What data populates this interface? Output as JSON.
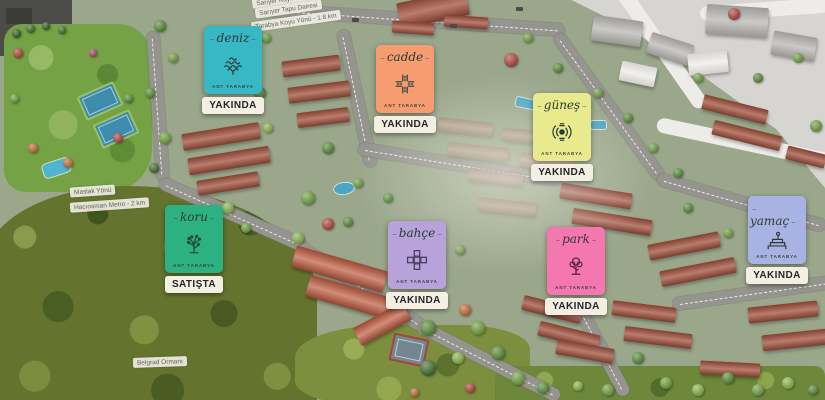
{
  "project": {
    "brand_label": "ANT TARABYA"
  },
  "cards": [
    {
      "name": "deniz",
      "brand": "ANT TARABYA",
      "status": "YAKINDA",
      "color": "#38b7c4",
      "icon": "sea-waves-icon"
    },
    {
      "name": "cadde",
      "brand": "ANT TARABYA",
      "status": "YAKINDA",
      "color": "#f59d70",
      "icon": "street-crossing-icon"
    },
    {
      "name": "güneş",
      "brand": "ANT TARABYA",
      "status": "YAKINDA",
      "color": "#e9e98d",
      "icon": "sun-icon"
    },
    {
      "name": "yamaç",
      "brand": "ANT TARABYA",
      "status": "YAKINDA",
      "color": "#a9b3e3",
      "icon": "hillside-icon"
    },
    {
      "name": "koru",
      "brand": "ANT TARABYA",
      "status": "SATIŞTA",
      "color": "#2db183",
      "icon": "grove-tree-icon"
    },
    {
      "name": "bahçe",
      "brand": "ANT TARABYA",
      "status": "YAKINDA",
      "color": "#b7a3da",
      "icon": "garden-plots-icon"
    },
    {
      "name": "park",
      "brand": "ANT TARABYA",
      "status": "YAKINDA",
      "color": "#f477b0",
      "icon": "park-tree-icon"
    }
  ],
  "map_labels": {
    "kaymakamlik": "Sarıyer Kaymakamlığı",
    "tapu": "Sarıyer Tapu Dairesi",
    "koy": "Tarabya Koyu Yönü - 1.8 km",
    "maslak": "Maslak Yönü",
    "metro": "Hacıosman Metro - 2 km",
    "orman": "Belgrad Ormanı"
  },
  "badge_style": {
    "background": "#f4efe3",
    "text": "#26262a"
  }
}
